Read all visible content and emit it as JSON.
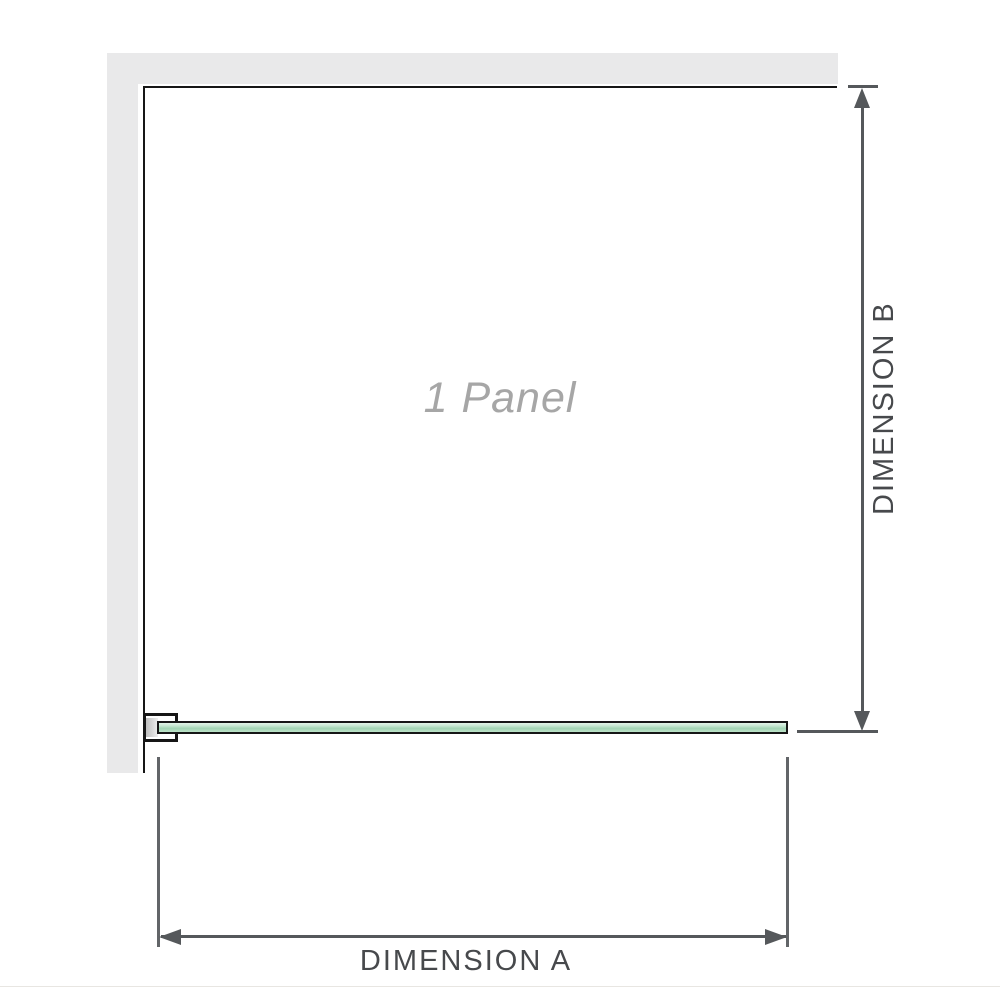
{
  "diagram": {
    "title": "1 Panel",
    "dimension_a": {
      "label": "DIMENSION A"
    },
    "dimension_b": {
      "label": "DIMENSION B"
    }
  },
  "colors": {
    "wall_fill": "#e9e9ea",
    "panel_outline": "#161616",
    "glass_green_light": "#e3f3e9",
    "glass_green_soft": "#c8e8d3",
    "glass_green_mid": "#a2d4b4",
    "glass_green_soft2": "#bde3c9",
    "dimension_line": "#55585b",
    "dimension_text": "#47494c",
    "panel_title_color": "#a6a6a6",
    "baseline_rule": "#e8e6e2"
  }
}
